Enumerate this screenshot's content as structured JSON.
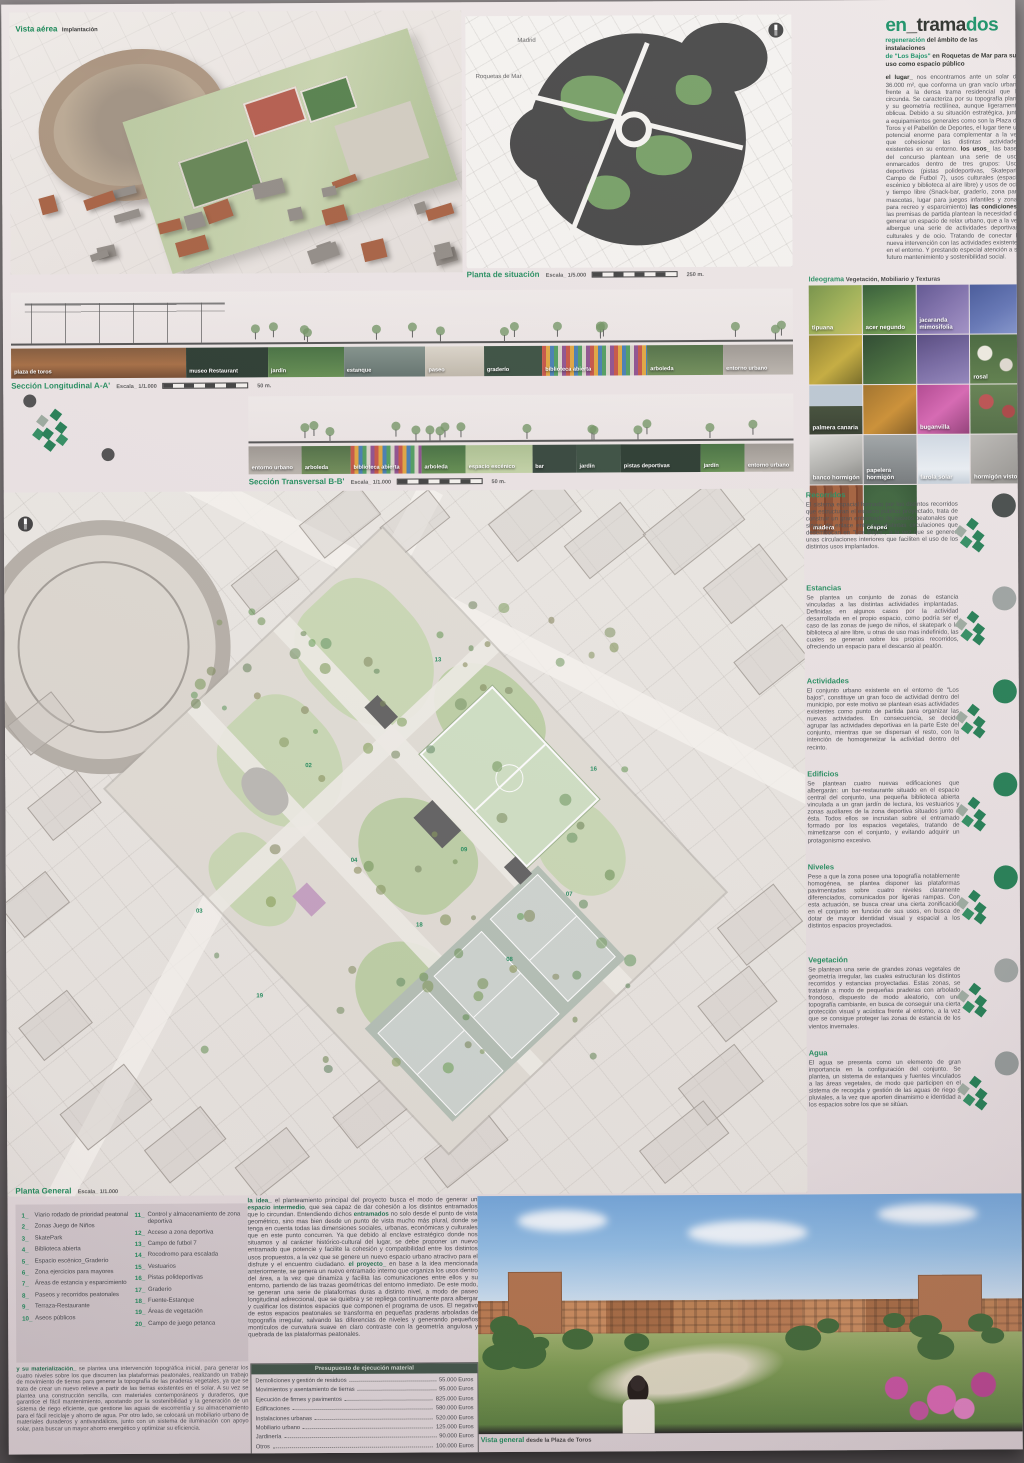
{
  "accent_green": "#1e8a5a",
  "aerial": {
    "label": "Vista aérea",
    "sublabel": "Implantación"
  },
  "situacion": {
    "label": "Planta de situación",
    "escala": "Escala_ 1/5.000",
    "scale_end": "250 m.",
    "map_label_1": "Madrid",
    "map_label_2": "Roquetas de Mar"
  },
  "titleblock": {
    "title_en": "en",
    "title_trama": "_trama",
    "title_dos": "dos",
    "subtitle_1a": "regeneración",
    "subtitle_1b": " del ámbito de las instalaciones",
    "subtitle_2a": "de \"Los Bajos\"",
    "subtitle_2b": " en Roquetas de Mar para su uso ",
    "subtitle_2c": "como espacio público",
    "intro_runs": [
      {
        "b": "el lugar_"
      },
      {
        "t": " nos encontramos ante un solar de 36.000 m², que conforma un gran vacío urbano frente a la densa trama residencial que lo circunda. Se caracteriza por su topografía plana y su geometría rectilínea, aunque ligeramente oblicua. Debido a su situación estratégica, junto a equipamientos generales como son la Plaza de Toros y el Pabellón de Deportes, el lugar tiene un potencial enorme para complementar a la vez que cohesionar las distintas actividades existentes en su entorno. "
      },
      {
        "b": "los usos_"
      },
      {
        "t": " las bases del concurso plantean una serie de usos enmarcados dentro de tres grupos: Usos deportivos (pistas polideportivas, Skatepark, Campo de Futbol 7), usos culturales (espacio escénico y biblioteca al aire libre) y usos de ocio y tiempo libre (Snack-bar, graderío, zona para mascotas, lugar para juegos infantiles y zonas para recreo y esparcimiento) "
      },
      {
        "b": "las condiciones_"
      },
      {
        "t": " las premisas de partida plantean la necesidad de generar un espacio de relax urbano, que a la vez albergue una serie de actividades deportivas, culturales y de ocio. Tratando de conectar la nueva intervención con las actividades existentes en el entorno. Y prestando especial atención a su futuro mantenimiento y sostenibilidad social."
      }
    ]
  },
  "ideograma": {
    "label": "Ideograma",
    "sublabel": " Vegetación, Mobiliario y Texturas",
    "tiles": [
      {
        "label": "tipuana",
        "cls": "t-tip"
      },
      {
        "label": "acer negundo",
        "cls": "t-acer"
      },
      {
        "label": "jacaranda mimosifolia",
        "cls": "t-jac"
      },
      {
        "label": "",
        "cls": "t-azul"
      },
      {
        "label": "",
        "cls": "t-amar"
      },
      {
        "label": "",
        "cls": "t-verde"
      },
      {
        "label": "",
        "cls": "t-jac2"
      },
      {
        "label": "rosal",
        "cls": "t-rosal"
      },
      {
        "label": "palmera canaria",
        "cls": "t-palm"
      },
      {
        "label": "",
        "cls": "t-nar"
      },
      {
        "label": "buganvilla",
        "cls": "t-bug"
      },
      {
        "label": "",
        "cls": "t-rojo"
      },
      {
        "label": "banco hormigón",
        "cls": "t-banco"
      },
      {
        "label": "papelera hormigón",
        "cls": "t-pap"
      },
      {
        "label": "farola solar",
        "cls": "t-farola"
      },
      {
        "label": "hormigón visto",
        "cls": "t-horm"
      },
      {
        "label": "madera",
        "cls": "t-mad"
      },
      {
        "label": "césped",
        "cls": "t-cesped"
      }
    ]
  },
  "long_section": {
    "label": "Sección Longitudinal A-A'",
    "escala": "Escala_ 1/1.000",
    "scale_end": "50 m.",
    "strip": [
      {
        "label": "plaza de toros",
        "cls": "s-toros",
        "grow": "3"
      },
      {
        "label": "museo Restaurant",
        "cls": "s-dark",
        "grow": "1.4"
      },
      {
        "label": "jardín",
        "cls": "s-jardin",
        "grow": "1.3"
      },
      {
        "label": "estanque",
        "cls": "s-estanque",
        "grow": "1.4"
      },
      {
        "label": "paseo",
        "cls": "s-paseo",
        "grow": "1"
      },
      {
        "label": "graderío",
        "cls": "s-graderio",
        "grow": "1"
      },
      {
        "label": "biblioteca abierta",
        "cls": "s-biblio",
        "grow": "1.8"
      },
      {
        "label": "arboleda",
        "cls": "s-arbol",
        "grow": "1.3"
      },
      {
        "label": "entorno urbano",
        "cls": "s-urb",
        "grow": "1.2"
      }
    ]
  },
  "trans_section": {
    "label": "Sección Transversal B-B'",
    "escala": "Escala_ 1/1.000",
    "scale_end": "50 m.",
    "strip": [
      {
        "label": "entorno urbano",
        "cls": "s-urb",
        "grow": "1.2"
      },
      {
        "label": "arboleda",
        "cls": "s-arbol",
        "grow": "1.1"
      },
      {
        "label": "biblioteca abierta",
        "cls": "s-biblio",
        "grow": "1.6"
      },
      {
        "label": "arboleda",
        "cls": "s-jardin",
        "grow": "1"
      },
      {
        "label": "espacio escénico",
        "cls": "s-esc",
        "grow": "1.5"
      },
      {
        "label": "bar",
        "cls": "s-bar",
        "grow": "1"
      },
      {
        "label": "jardín",
        "cls": "s-graderio",
        "grow": "1"
      },
      {
        "label": "pistas deportivas",
        "cls": "s-dark",
        "grow": "1.8"
      },
      {
        "label": "jardín",
        "cls": "s-jardin",
        "grow": "1"
      },
      {
        "label": "entorno urbano",
        "cls": "s-urb",
        "grow": "1.1"
      }
    ]
  },
  "planta_general": {
    "label": "Planta General",
    "escala": "Escala_ 1/1.000"
  },
  "topics": [
    {
      "title": "Recorridos",
      "dot": "#3f4543",
      "text": "El sistema espacial formado por los distintos recorridos que estructuran el espacio público proyectado, trata de construir un gran entramado de paseos peatonales que sirvan de enlace entre las distintas circulaciones que desembocan en \"Los Bajos\", a la vez que se generen unas circulaciones interiores que faciliten el uso de los distintos usos implantados."
    },
    {
      "title": "Estancias",
      "dot": "#9aa09e",
      "text": "Se plantea un conjunto de zonas de estancia vinculadas a las distintas actividades implantadas. Definidas en algunos casos por la actividad desarrollada en el propio espacio, como podría ser el caso de las zonas de juego de niños, el skatepark o la biblioteca al aire libre, u otras de uso mas indefinido, las cuales se generan sobre los propios recorridos, ofreciendo un espacio para el descanso al peatón."
    },
    {
      "title": "Actividades",
      "dot": "#1d7a4f",
      "text": "El conjunto urbano existente en el entorno de \"Los bajos\", constituye un gran foco de actividad dentro del municipio, por este motivo se plantean esas actividades existentes como punto de partida para organizar las nuevas actividades. En consecuencia, se decide agrupar las actividades deportivas en la parte Este del conjunto, mientras que se dispersan el resto, con la intención de homogeneizar la actividad dentro del recinto."
    },
    {
      "title": "Edificios",
      "dot": "#1d7a4f",
      "text": "Se plantean cuatro nuevas edificaciones que albergarán: un bar-restaurante situado en el espacio central del conjunto, una pequeña biblioteca abierta vinculada a un gran jardín de lectura, los vestuarios y zonas auxiliares de la zona deportiva situados junto a ésta. Todos ellos se incrustan sobre el entramado formado por los espacios vegetales, tratando de mimetizarse con el conjunto, y evitando adquirir un protagonismo excesivo."
    },
    {
      "title": "Niveles",
      "dot": "#1d7a4f",
      "text": "Pese a que la zona posee una topografía notablemente homogénea, se plantea disponer las plataformas pavimentadas sobre cuatro niveles claramente diferenciados, comunicados por ligeras rampas. Con esta actuación, se busca crear una cierta zonificación en el conjunto en función de sus usos, en busca de dotar de mayor identidad visual y espacial a los distintos espacios proyectados."
    },
    {
      "title": "Vegetación",
      "dot": "#9aa09e",
      "text": "Se plantean una serie de grandes zonas vegetales de geometría irregular, las cuales estructuran los distintos recorridos y estancias proyectadas. Estas zonas, se tratarán a modo de pequeñas praderas con arbolado frondoso, dispuesto de modo aleatorio, con una topografía cambiante, en busca de conseguir una cierta protección visual y acústica frente al entorno, a la vez que se consigue proteger las zonas de estancia de los vientos invernales."
    },
    {
      "title": "Agua",
      "dot": "#8f9694",
      "text": "El agua se presenta como un elemento de gran importancia en la configuración del conjunto. Se plantea, un sistema de estanques y fuentes vinculados a las áreas vegetales, de modo que participen en el sistema de recogida y gestión de las aguas de riego y pluviales, a la vez que aporten dinamismo e identidad a los espacios sobre los que se sitúan."
    }
  ],
  "legend": {
    "items_left": [
      {
        "num": "1_",
        "label": "Viario rodado de prioridad peatonal"
      },
      {
        "num": "2_",
        "label": "Zonas Juego de Niños"
      },
      {
        "num": "3_",
        "label": "SkatePark"
      },
      {
        "num": "4_",
        "label": "Biblioteca abierta"
      },
      {
        "num": "5_",
        "label": "Espacio escénico_Graderío"
      },
      {
        "num": "6_",
        "label": "Zona ejercicios para mayores"
      },
      {
        "num": "7_",
        "label": "Áreas de estancia y esparcimiento"
      },
      {
        "num": "8_",
        "label": "Paseos y recorridos peatonales"
      },
      {
        "num": "9_",
        "label": "Terraza-Restaurante"
      },
      {
        "num": "10_",
        "label": "Aseos públicos"
      }
    ],
    "items_right": [
      {
        "num": "11_",
        "label": "Control y almacenamiento de zona deportiva"
      },
      {
        "num": "12_",
        "label": "Acceso a zona deportiva"
      },
      {
        "num": "13_",
        "label": "Campo de futbol 7"
      },
      {
        "num": "14_",
        "label": "Rocodromo para escalada"
      },
      {
        "num": "15_",
        "label": "Vestuarios"
      },
      {
        "num": "16_",
        "label": "Pistas polideportivas"
      },
      {
        "num": "17_",
        "label": "Graderío"
      },
      {
        "num": "18_",
        "label": "Fuente-Estanque"
      },
      {
        "num": "19_",
        "label": "Áreas de vegetación"
      },
      {
        "num": "20_",
        "label": "Campo de juego petanca"
      }
    ]
  },
  "materializacion_runs": [
    {
      "b": "y su materialización_"
    },
    {
      "t": " se plantea una intervención topográfica inicial, para generar los cuatro niveles sobre los que discurren las plataformas peatonales, realizando un trabajo de movimiento de tierras para generar la topografía de las praderas vegetales, ya que se trata de crear un nuevo relieve a partir de las tierras existentes en el solar. A su vez se plantea una construcción sencilla, con materiales contemporáneos y duraderos, que garantice el fácil mantenimiento, apostando por la sostenibilidad y la generación de un sistema de riego eficiente, que gestione las aguas de escorrentía y su almacenamiento para el fácil reciclaje y ahorro de agua. Por otro lado, se colocará un mobiliario urbano de materiales duraderos y antivandálicos, junto con un sistema de iluminación con apoyo solar, para buscar un mayor ahorro energético y optimizar su eficiencia."
    }
  ],
  "idea_runs": [
    {
      "b": "la idea_"
    },
    {
      "t": " el planteamiento principal del proyecto busca el modo de generar un "
    },
    {
      "b": "espacio intermedio"
    },
    {
      "t": ", que sea capaz de dar cohesión a los distintos entramados que lo circundan. Entendiendo dichos "
    },
    {
      "b": "entramados"
    },
    {
      "t": " no solo desde el punto de vista geométrico, sino mas bien desde un punto de vista mucho más plural, donde se tenga en cuenta todas las dimensiones sociales, urbanas, económicas y culturales que en este punto concurren. Ya que debido al enclave estratégico donde nos situamos y al carácter histórico-cultural del lugar, se debe proponer un nuevo entramado que potencie y facilite la cohesión y compatibilidad entre los distintos usos propuestos, a la vez que se genere un nuevo espacio urbano atractivo para el disfrute y el encuentro ciudadano. "
    },
    {
      "b": "el proyecto_"
    },
    {
      "t": " en base a la idea mencionada anteriormente, se genera un nuevo entramado interno que organiza los usos dentro del área, a la vez que dinamiza y facilita las comunicaciones entre ellos y su entorno, partiendo de las trazas geométricas del entorno inmediato. De este modo, se generan una serie de plataformas duras a distinto nivel, a modo de paseo longitudinal adireccional, que se quiebra y se repliega continuamente para albergar y cualificar los distintos espacios que componen el programa de usos. El negativo de estos espacios peatonales se transforma en pequeñas praderas arboladas de topografía irregular, salvando las diferencias de niveles y generando pequeños montículos de curvatura suave en claro contraste con la geometría angulosa y quebrada de las plataformas peatonales."
    }
  ],
  "budget": {
    "header": "Presupuesto de ejecución material",
    "rows": [
      {
        "label": "Demoliciones y gestión de residuos",
        "value": "55.000 Euros"
      },
      {
        "label": "Movimientos y asentamiento de tierras",
        "value": "95.000 Euros"
      },
      {
        "label": "Ejecución de firmes y pavimentos",
        "value": "825.000 Euros"
      },
      {
        "label": "Edificaciones",
        "value": "580.000 Euros"
      },
      {
        "label": "Instalaciones urbanas",
        "value": "520.000 Euros"
      },
      {
        "label": "Mobiliario urbano",
        "value": "125.000 Euros"
      },
      {
        "label": "Jardinería",
        "value": "90.000 Euros"
      },
      {
        "label": "Otros",
        "value": "100.000 Euros"
      }
    ],
    "total_label": "PEM",
    "total_value": "3.200.000 Euros"
  },
  "vista_general": {
    "label": "Vista general",
    "sublabel": " desde la Plaza de Toros"
  }
}
